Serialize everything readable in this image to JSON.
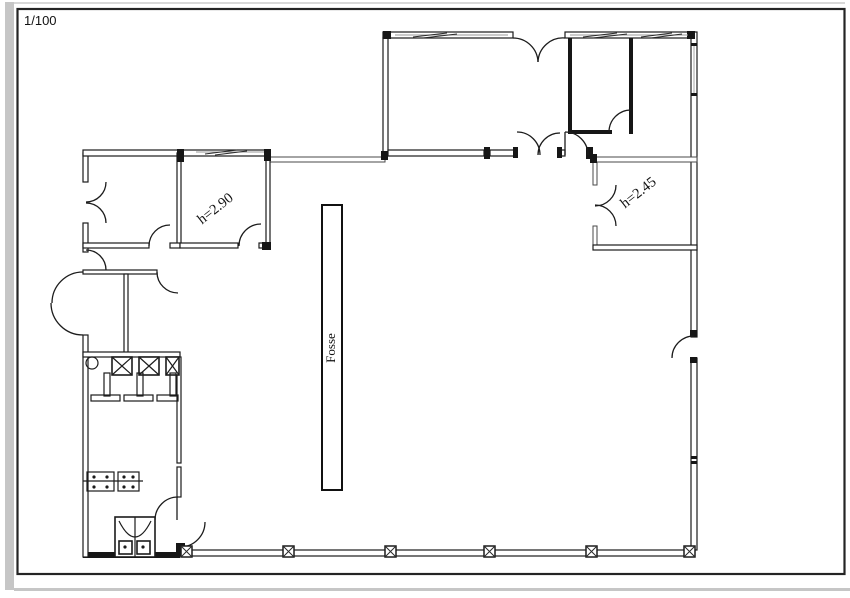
{
  "page": {
    "type": "architectural-floor-plan"
  },
  "labels": {
    "scale": "1/100",
    "room_b_height": "h=2.90",
    "room_e_height": "h=2.45",
    "pit": "Fosse"
  },
  "colors": {
    "line": "#1c1c1c",
    "gray_wall": "#4a4a4a",
    "frame": "#242424",
    "page_edge": "#c6c6c6",
    "background": "#ffffff"
  },
  "icons": [
    "door-swing-arc",
    "double-door-arc",
    "window-hatch",
    "column-post",
    "wc-stall-x",
    "stall-partition",
    "sink-circle",
    "washbasin",
    "bench-table",
    "pit-rectangle"
  ]
}
